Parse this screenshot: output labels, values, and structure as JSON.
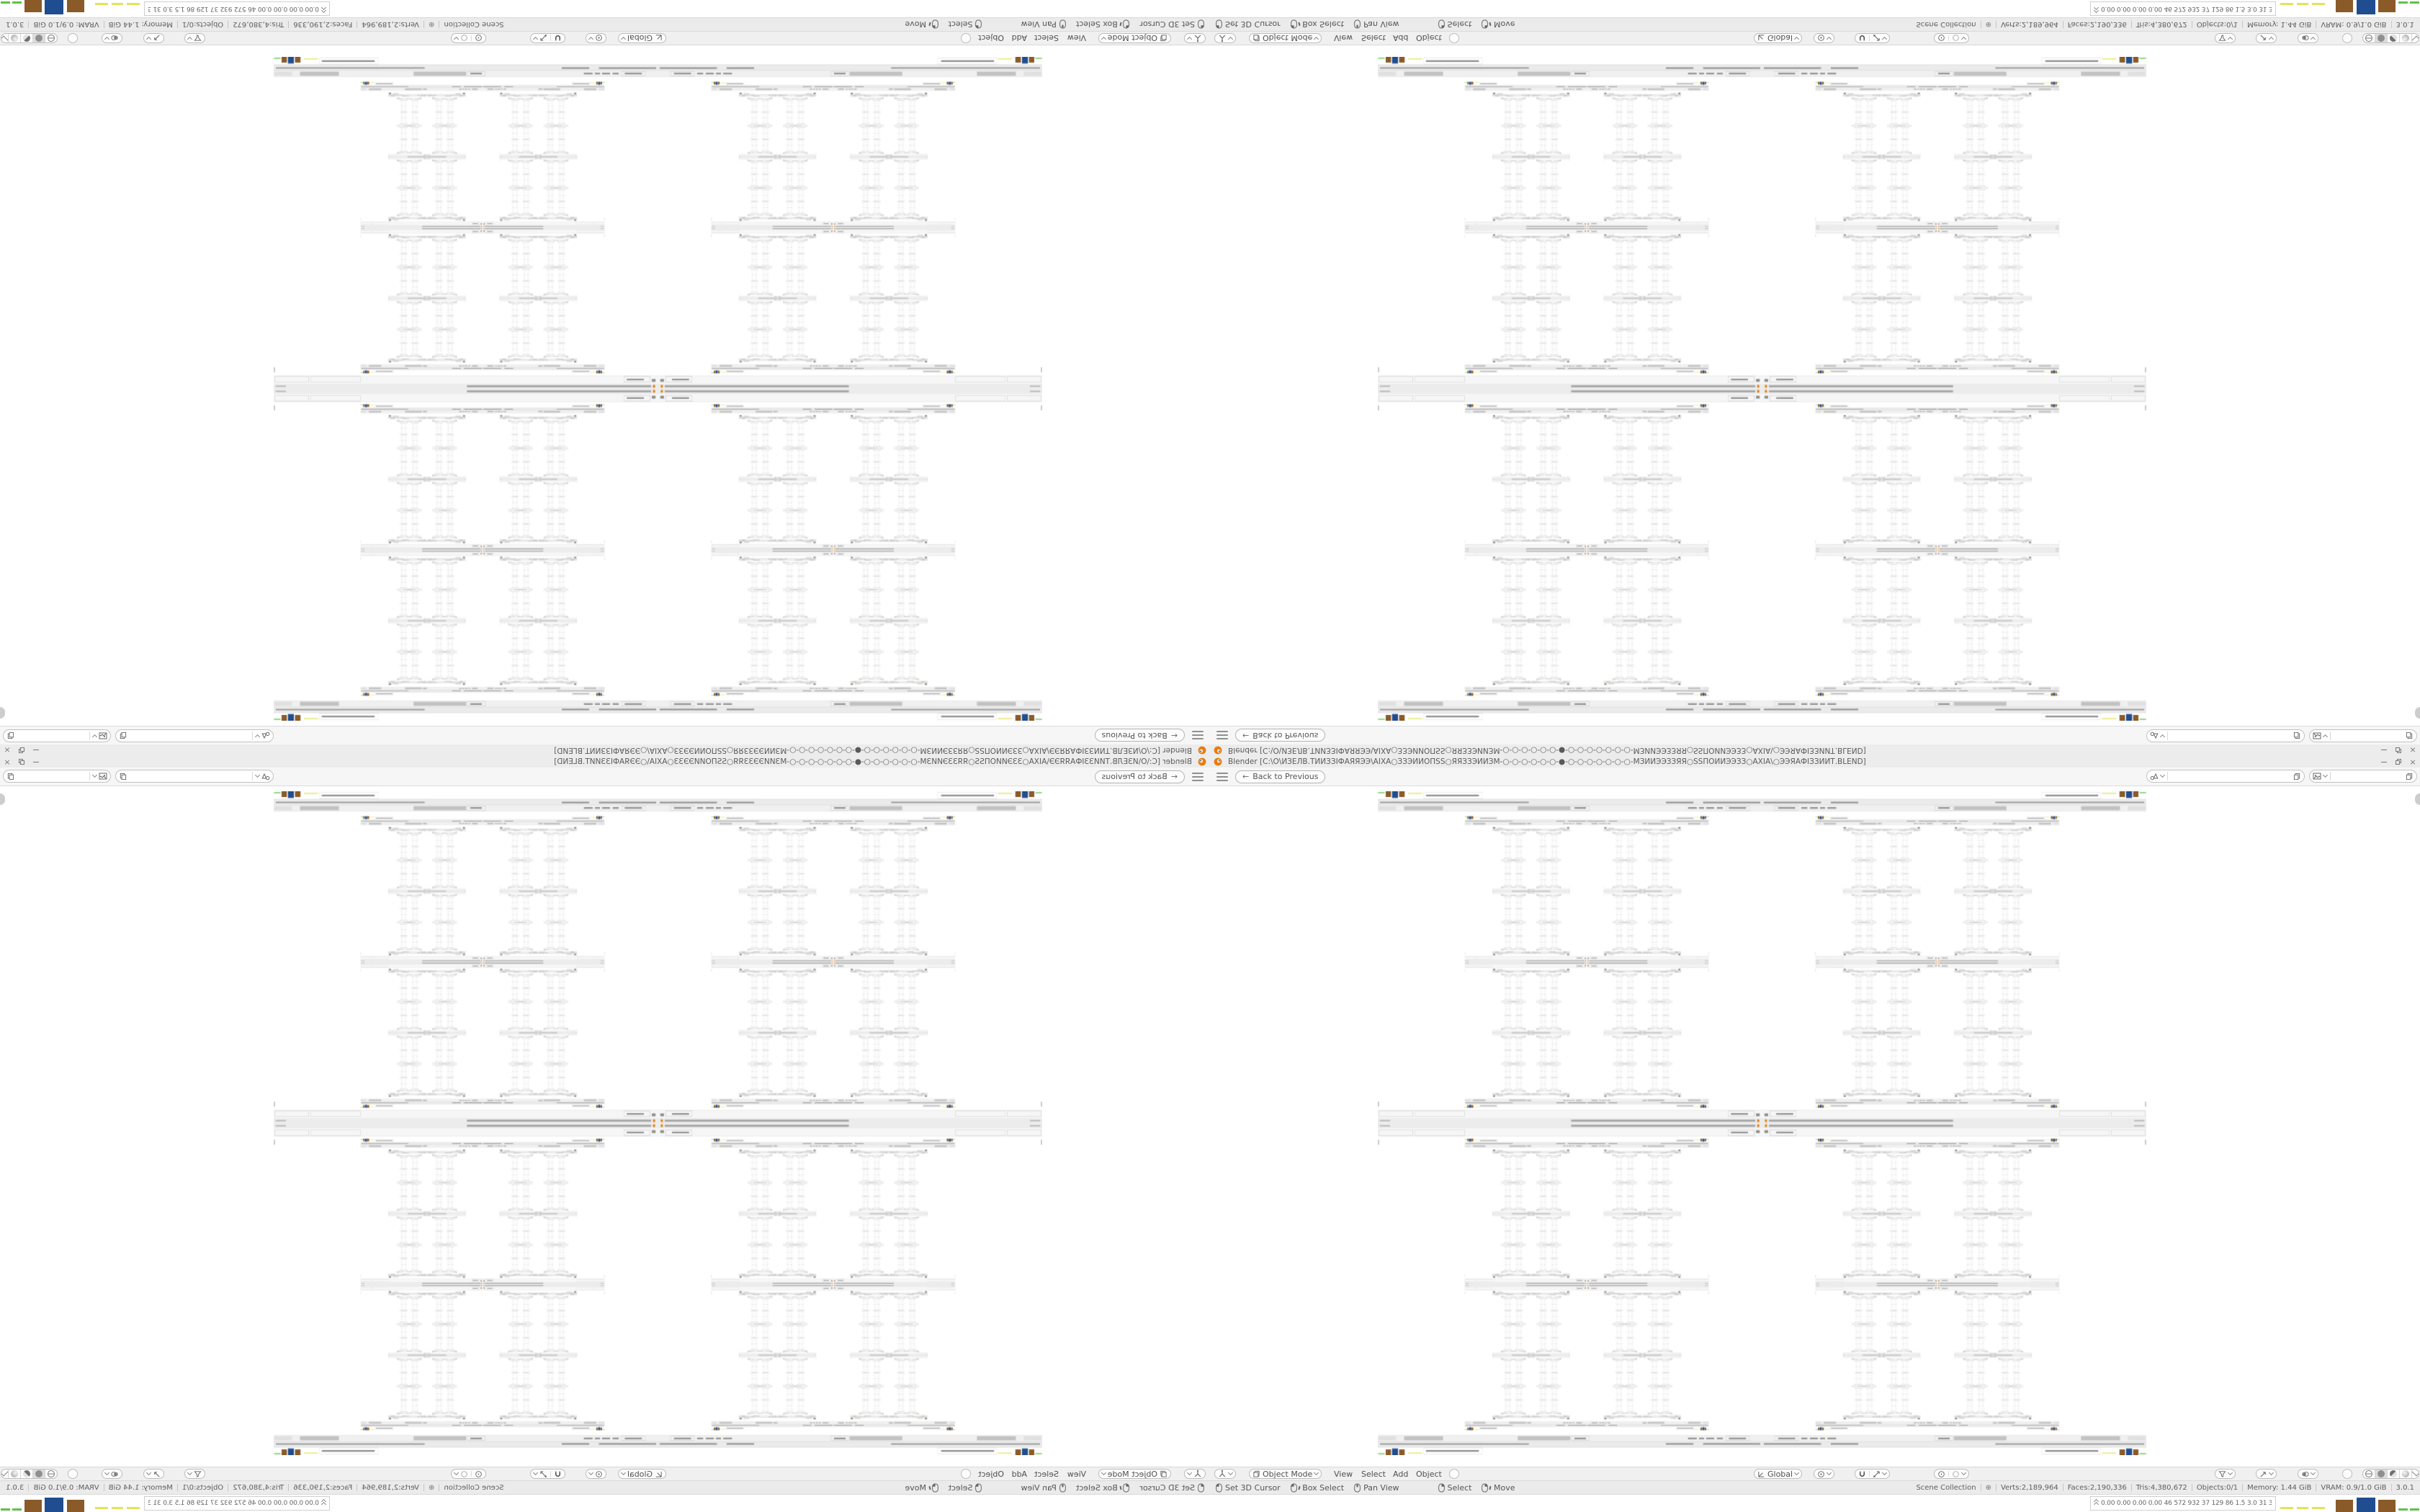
{
  "app": {
    "title": "Blender [C:\\O\\ИЗЕЛВ.ТИИЗЗІФАЯЯЭЭ\\АІХА○ЗЗЭИИОПЅЅ○ЯЯЗЗЭИИЗМ-○-○-○-○-○-○-●-○-○-○-○-○-○-○-МЗИИЭЭЗЗЯЯ○ЅЅПОИИЭЭЗЗ○АХІА\\○ЭЭЯАФІЗЗИИТ.BLEND]",
    "close_label": "×",
    "version": "3.0.1"
  },
  "topbar": {
    "back_button": "Back to Previous",
    "back_arrow": "←"
  },
  "header": {
    "mode": "Object Mode",
    "menus": [
      "View",
      "Select",
      "Add",
      "Object"
    ],
    "orientation": "Global"
  },
  "status_bar": {
    "hints": [
      {
        "icon": "mouse-left",
        "label": "Set 3D Cursor"
      },
      {
        "icon": "mouse-left-drag",
        "label": "Box Select"
      },
      {
        "icon": "mouse-middle",
        "label": "Pan View"
      },
      {
        "icon": "mouse-right",
        "label": "Select"
      },
      {
        "icon": "mouse-right-drag",
        "label": "Move"
      }
    ],
    "stats": {
      "scene": "Scene Collection",
      "display_icon": "⊕",
      "verts": "Verts:2,189,964",
      "faces": "Faces:2,190,336",
      "tris": "Tris:4,380,672",
      "objects": "Objects:0/1",
      "memory": "Memory: 1.44 GiB",
      "vram": "VRAM: 0.9/1.0 GiB",
      "version": "3.0.1"
    }
  },
  "taskbar": {
    "numbers": "0.00 0.00 0.00 0.00  46  572  932  37  129  86  1.5  3.0  31  31  7153|086"
  },
  "colors": {
    "accent_orange": "#e87d0d",
    "block_brown": "#8a5a28",
    "block_blue": "#1f4d8f",
    "block_yellow": "#e3e35a",
    "block_green": "#5cc245"
  }
}
